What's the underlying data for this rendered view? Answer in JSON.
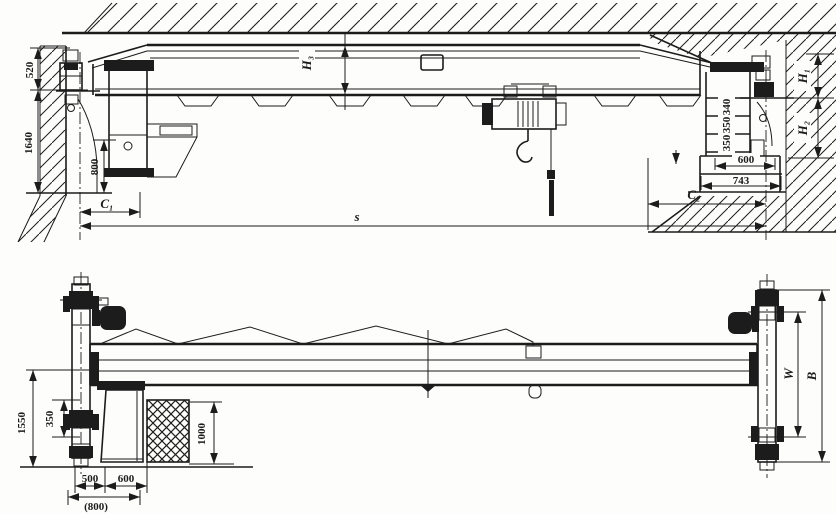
{
  "colors": {
    "ink": "#1c1c1c",
    "paper": "#fdfdfb"
  },
  "top_view": {
    "description": "single girder overhead crane - elevation view",
    "dims": {
      "d520": "520",
      "d1640": "1640",
      "d800": "800",
      "c1": "C₁",
      "span": "s",
      "h3": "H₃",
      "h1": "H₁",
      "h2": "H₂",
      "ladder_top": "340",
      "ladder_mid": "350",
      "ladder_bot": "350",
      "d600": "600",
      "d743": "743",
      "c2": "C₂"
    }
  },
  "bottom_view": {
    "description": "single girder overhead crane - plan view",
    "dims": {
      "d1550": "1550",
      "d350": "350",
      "d500": "500",
      "d600": "600",
      "d800_alt": "(800)",
      "d1000": "1000",
      "wheel_gauge": "W",
      "overall_width": "B"
    }
  }
}
